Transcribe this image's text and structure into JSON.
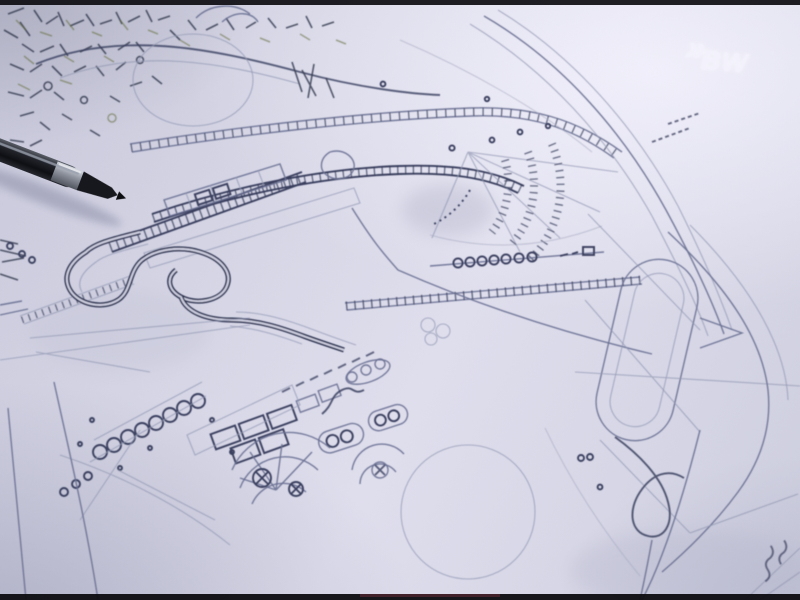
{
  "frame": {
    "width_px": 800,
    "height_px": 600,
    "kind": "video still photograph"
  },
  "letterbox": {
    "top_bar": true,
    "bottom_bar": true
  },
  "broadcast_logo": {
    "chevrons": "»",
    "text": "BW"
  },
  "scene": {
    "subject": "Hand-drawn amusement ride layout plan on paper, photographed at an angle",
    "objects": [
      {
        "name": "blueprint-drawing",
        "description": "pencil site plan: winding flume track, station buildings with tie marks, radial fan of hatches, rows of small circular cars, oval loops, rosette structures and faint circles"
      },
      {
        "name": "pen",
        "description": "dark pen with metallic band lying across the upper-left of the drawing"
      },
      {
        "name": "broadcast-logo",
        "description": "semi-transparent white chevrons + BW watermark, top right"
      }
    ]
  },
  "palette": {
    "paper": "#d8d8e7",
    "paper_highlight": "#eceaf6",
    "paper_shadow": "#b9bad0",
    "ink_faint": "#9297b2",
    "ink_mid": "#6a7092",
    "ink_dark": "#3a3f5e",
    "ink_heavy": "#272b45",
    "vegetation_tint": "#66703f",
    "pen_body": "#17191f",
    "pen_metal": "#9ba0ab",
    "logo_white": "#f4f3fd",
    "letterbox": "#0c0c10"
  }
}
